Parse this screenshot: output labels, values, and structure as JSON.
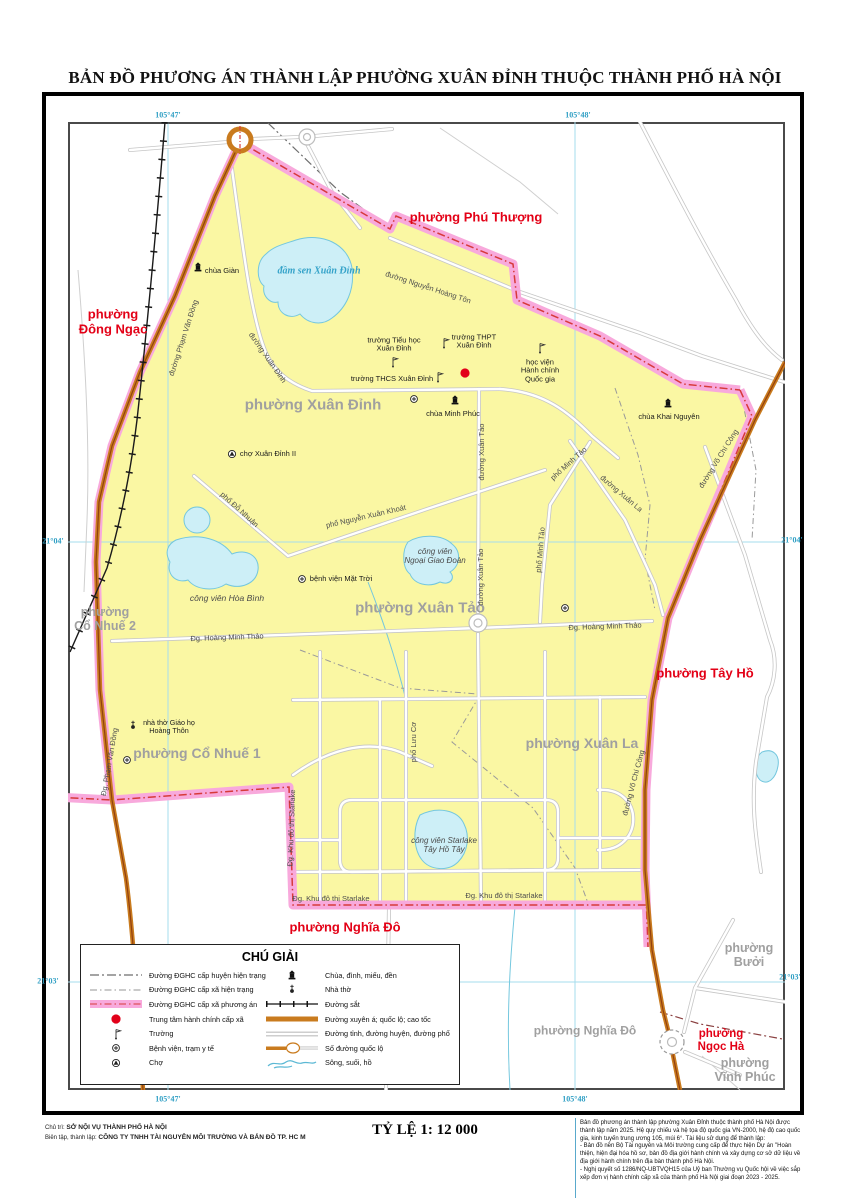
{
  "title": "BẢN ĐỒ PHƯƠNG ÁN THÀNH LẬP PHƯỜNG XUÂN ĐỈNH THUỘC THÀNH PHỐ HÀ NỘI",
  "colors": {
    "ward_fill": "#FAF7A3",
    "plan_boundary_pink": "#F8A9DC",
    "boundary_dash_red": "#D63A3A",
    "highway_orange": "#C97B1E",
    "water_fill": "#CDEFF7",
    "graticule_cyan": "#49A8C8",
    "new_ward_label_red": "#E30016",
    "current_ward_label_gray": "#A0A0A0",
    "admin_center_red": "#E2001A"
  },
  "graticule": {
    "top": [
      "105°47'",
      "105°48'"
    ],
    "bottom": [
      "105°47'",
      "105°48'"
    ],
    "left": [
      "21°04'",
      "21°03'"
    ],
    "right": [
      "21°04'",
      "21°03'"
    ]
  },
  "wards_red": [
    {
      "label": "phường Phú Thượng"
    },
    {
      "label": "phường\nĐông Ngạc"
    },
    {
      "label": "phường Tây Hồ"
    },
    {
      "label": "phường Nghĩa Đô"
    },
    {
      "label": "phường\nNgọc Hà"
    }
  ],
  "wards_gray": [
    {
      "label": "phường Xuân Đỉnh"
    },
    {
      "label": "phường Xuân Tảo"
    },
    {
      "label": "phường Xuân La"
    },
    {
      "label": "phường\nCổ Nhuế 2"
    },
    {
      "label": "phường Cổ Nhuế 1"
    },
    {
      "label": "phường\nBưởi"
    },
    {
      "label": "phường Nghĩa Đô"
    },
    {
      "label": "phường\nVĩnh Phúc"
    }
  ],
  "water_labels": [
    {
      "label": "đầm sen Xuân Đỉnh"
    },
    {
      "label": "công viên Hòa Bình"
    },
    {
      "label": "công viên\nNgoại Giao Đoàn"
    },
    {
      "label": "công viên Starlake\nTây Hồ Tây"
    }
  ],
  "poi_labels": [
    {
      "label": "chùa Giàn"
    },
    {
      "label": "chùa Minh Phúc"
    },
    {
      "label": "chùa Khai Nguyên"
    },
    {
      "label": "chợ Xuân Đỉnh II"
    },
    {
      "label": "nhà thờ Giáo họ\nHoàng Thôn"
    },
    {
      "label": "bệnh viện Mặt Trời"
    },
    {
      "label": "trường Tiểu học\nXuân Đỉnh"
    },
    {
      "label": "trường THPT\nXuân Đỉnh"
    },
    {
      "label": "trường THCS Xuân Đỉnh"
    },
    {
      "label": "học viện\nHành chính\nQuốc gia"
    }
  ],
  "road_labels": [
    {
      "label": "đường Nguyễn Hoàng Tôn"
    },
    {
      "label": "đường Phạm Văn Đồng"
    },
    {
      "label": "Đg. Phạm Văn Đồng"
    },
    {
      "label": "đường Xuân Đỉnh"
    },
    {
      "label": "đường Xuân Tảo"
    },
    {
      "label": "đường Xuân Tảo"
    },
    {
      "label": "phố Minh Tảo"
    },
    {
      "label": "phố Minh Tảo"
    },
    {
      "label": "đường Xuân La"
    },
    {
      "label": "đường Võ Chí Công"
    },
    {
      "label": "đường Võ Chí Công"
    },
    {
      "label": "phố Đỗ Nhuận"
    },
    {
      "label": "phố Nguyễn Xuân Khoát"
    },
    {
      "label": "Đg. Hoàng Minh Thảo"
    },
    {
      "label": "Đg. Hoàng Minh Thảo"
    },
    {
      "label": "phố Lưu Cơ"
    },
    {
      "label": "Đg. Khu đô thị Starlake"
    },
    {
      "label": "Đg. Khu đô thị Starlake"
    },
    {
      "label": "Đg. Khu đô thị Starlake"
    }
  ],
  "legend": {
    "title": "CHÚ GIẢI",
    "left": [
      {
        "icon": "dash-dot-line-dark",
        "label": "Đường ĐGHC cấp huyện hiện trạng"
      },
      {
        "icon": "dash-dot-line-light",
        "label": "Đường ĐGHC cấp xã hiện trạng"
      },
      {
        "icon": "pink-band",
        "label": "Đường ĐGHC cấp xã phương án"
      },
      {
        "icon": "red-dot",
        "label": "Trung tâm hành chính cấp xã"
      },
      {
        "icon": "flag",
        "label": "Trường"
      },
      {
        "icon": "circle-plus",
        "label": "Bệnh viện, trạm y tế"
      },
      {
        "icon": "circle-triangle",
        "label": "Chợ"
      }
    ],
    "right": [
      {
        "icon": "pagoda",
        "label": "Chùa, đình, miếu, đền"
      },
      {
        "icon": "church",
        "label": "Nhà thờ"
      },
      {
        "icon": "railway",
        "label": "Đường sắt"
      },
      {
        "icon": "orange-band",
        "label": "Đường xuyên á; quốc lộ; cao tốc"
      },
      {
        "icon": "double-line",
        "label": "Đường tỉnh, đường huyện, đường phố"
      },
      {
        "icon": "route-number",
        "label": "Số đường quốc lộ"
      },
      {
        "icon": "river",
        "label": "Sông, suối, hồ"
      }
    ]
  },
  "footer": {
    "credit_label_1": "Chủ trì:",
    "credit_1": "SỞ NỘI VỤ THÀNH PHỐ HÀ NỘI",
    "credit_label_2": "Biên tập, thành lập:",
    "credit_2": "CÔNG TY TNHH TÀI NGUYÊN MÔI TRƯỜNG VÀ BẢN ĐỒ TP. HC M",
    "scale": "TỶ LỆ 1: 12 000",
    "notes": [
      "Bản đồ phương án thành lập phường Xuân Đỉnh thuộc thành phố Hà Nội được thành lập năm 2025. Hệ quy chiếu và hệ tọa độ quốc gia VN-2000, hệ độ cao quốc gia, kinh tuyến trung ương 105, múi 6°. Tài liệu sử dụng để thành lập:",
      "- Bản đồ nền Bộ Tài nguyên và Môi trường cung cấp để thực hiện Dự án \"Hoàn thiện, hiện đại hóa hồ sơ, bản đồ địa giới hành chính và xây dựng cơ sở dữ liệu về địa giới hành chính trên địa bàn thành phố Hà Nội.",
      "- Nghị quyết số 1286/NQ-UBTVQH15 của Uỷ ban Thường vụ Quốc hội về việc sắp xếp đơn vị hành chính cấp xã của thành phố Hà Nội giai đoạn 2023 - 2025."
    ]
  }
}
